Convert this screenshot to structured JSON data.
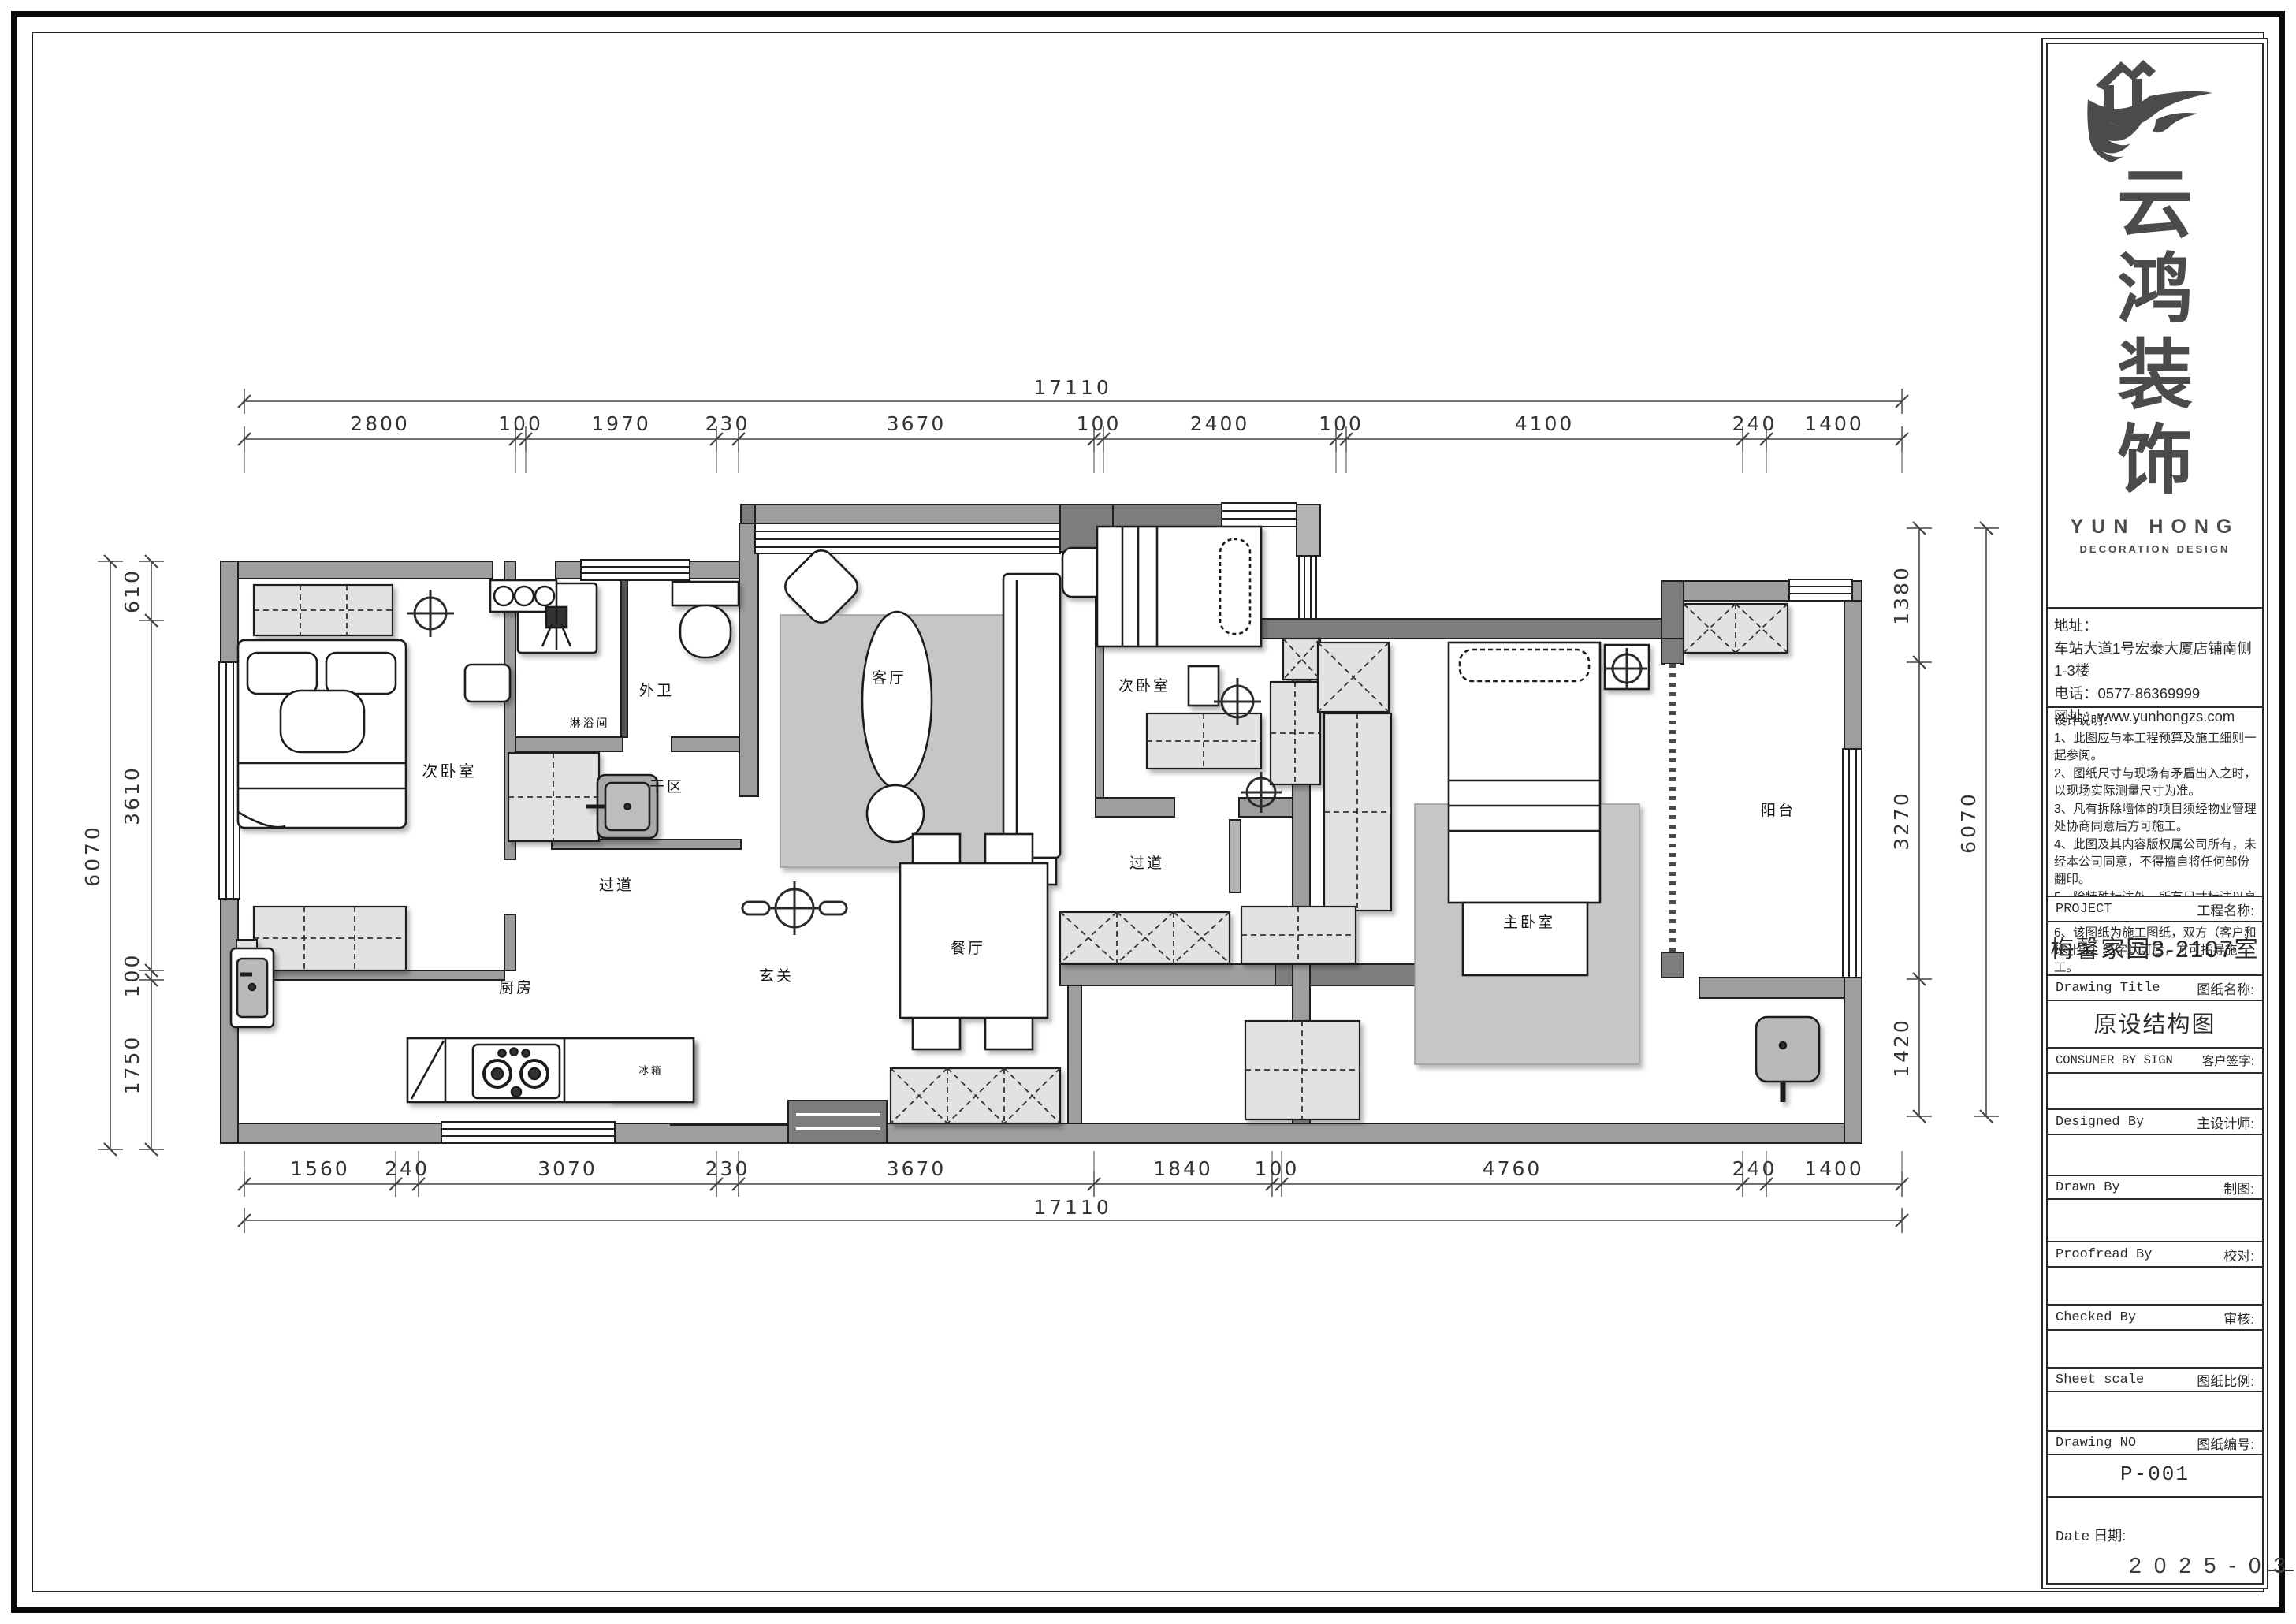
{
  "title_block": {
    "logo": {
      "chars": "云鸿装饰",
      "en_name": "YUN HONG",
      "en_sub": "DECORATION DESIGN",
      "brand_color": "#4b4b4b"
    },
    "contact": {
      "address_label": "地址：",
      "address": "车站大道1号宏泰大厦店铺南侧1-3楼",
      "phone_label": "电话：",
      "phone": "0577-86369999",
      "web_label": "网址：",
      "website": "www.yunhongzs.com"
    },
    "notes_title": "设计说明：",
    "notes": [
      "1、此图应与本工程预算及施工细则一起参阅。",
      "2、图纸尺寸与现场有矛盾出入之时，以现场实际测量尺寸为准。",
      "3、凡有拆除墙体的项目须经物业管理处协商同意后方可施工。",
      "4、此图及其内容版权属公司所有，未经本公司同意，不得擅自将任何部份翻印。",
      "5、除特殊标注外，所有尺寸标注以毫米为单位。",
      "6、该图纸为施工图纸，双方（客户和设计师）签字认可后，方可指导施工。"
    ],
    "rows": {
      "project": {
        "en": "PROJECT",
        "zh": "工程名称:"
      },
      "drawing_title": {
        "en": "Drawing Title",
        "zh": "图纸名称:"
      },
      "consumer": {
        "en": "CONSUMER BY SIGN",
        "zh": "客户签字:"
      },
      "designed": {
        "en": "Designed By",
        "zh": "主设计师:"
      },
      "drawn": {
        "en": "Drawn By",
        "zh": "制图:"
      },
      "proofread": {
        "en": "Proofread By",
        "zh": "校对:"
      },
      "checked": {
        "en": "Checked By",
        "zh": "审核:"
      },
      "scale": {
        "en": "Sheet scale",
        "zh": "图纸比例:"
      },
      "number": {
        "en": "Drawing NO",
        "zh": "图纸编号:"
      },
      "date": {
        "en": "Date",
        "zh": "日期:"
      }
    },
    "project_name": "梅馨家园3-2107室",
    "drawing_title_value": "原设结构图",
    "drawing_no": "P-001",
    "date_value": "2025-03"
  },
  "plan": {
    "rooms": {
      "left_bedroom": "次卧室",
      "shower": "淋浴间",
      "bath": "外卫",
      "dry_area": "干区",
      "hallway_left": "过道",
      "living": "客厅",
      "bedroom2": "次卧室",
      "hallway_right": "过道",
      "dining": "餐厅",
      "foyer": "玄关",
      "kitchen": "厨房",
      "fridge": "冰箱",
      "master": "主卧室",
      "balcony": "阳台"
    },
    "dims": {
      "top_total": "17110",
      "top_segments": [
        "2800",
        "100",
        "1970",
        "230",
        "3670",
        "100",
        "2400",
        "100",
        "4100",
        "240",
        "1400"
      ],
      "bottom_segments": [
        "1560",
        "240",
        "3070",
        "230",
        "3670",
        "1840",
        "100",
        "4760",
        "240",
        "1400"
      ],
      "bottom_total": "17110",
      "left_segments": [
        "610",
        "3610",
        "100",
        "1750"
      ],
      "left_total": "6070",
      "right_segments": [
        "1380",
        "3270",
        "1420"
      ],
      "right_total": "6070"
    }
  }
}
